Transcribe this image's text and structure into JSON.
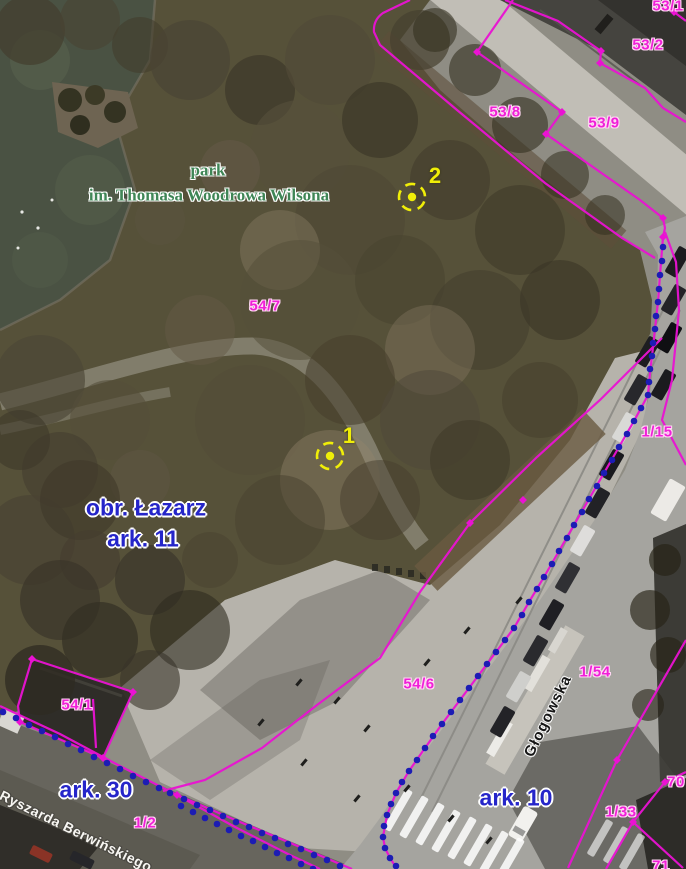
{
  "map": {
    "colors": {
      "boundary_line": "#ea12d3",
      "sheet_boundary_dot": "#1c1cb4",
      "marker_yellow": "#f0ee08",
      "parcel_label": "#f01fd8",
      "sheet_label": "#2525c9",
      "park_label": "#3f8656"
    },
    "labels": [
      {
        "name": "parcel-53-1",
        "text": "53/1",
        "x": 668,
        "y": 6,
        "cls": "parcel",
        "rot": 0
      },
      {
        "name": "parcel-53-2",
        "text": "53/2",
        "x": 648,
        "y": 45,
        "cls": "parcel",
        "rot": 0
      },
      {
        "name": "parcel-53-8",
        "text": "53/8",
        "x": 505,
        "y": 112,
        "cls": "parcel",
        "rot": 0
      },
      {
        "name": "parcel-53-9",
        "text": "53/9",
        "x": 604,
        "y": 123,
        "cls": "parcel",
        "rot": 0
      },
      {
        "name": "parcel-54-7",
        "text": "54/7",
        "x": 265,
        "y": 306,
        "cls": "parcel",
        "rot": 0
      },
      {
        "name": "parcel-1-15",
        "text": "1/15",
        "x": 657,
        "y": 432,
        "cls": "parcel",
        "rot": 0
      },
      {
        "name": "parcel-54-6",
        "text": "54/6",
        "x": 419,
        "y": 684,
        "cls": "parcel",
        "rot": 0
      },
      {
        "name": "parcel-1-54",
        "text": "1/54",
        "x": 595,
        "y": 672,
        "cls": "parcel",
        "rot": 0
      },
      {
        "name": "parcel-54-1",
        "text": "54/1",
        "x": 77,
        "y": 705,
        "cls": "parcel",
        "rot": 0
      },
      {
        "name": "parcel-1-2",
        "text": "1/2",
        "x": 145,
        "y": 823,
        "cls": "parcel",
        "rot": 0
      },
      {
        "name": "parcel-70",
        "text": "70",
        "x": 676,
        "y": 782,
        "cls": "parcel",
        "rot": 0
      },
      {
        "name": "parcel-1-33",
        "text": "1/33",
        "x": 621,
        "y": 812,
        "cls": "parcel",
        "rot": 0
      },
      {
        "name": "parcel-71",
        "text": "71",
        "x": 661,
        "y": 866,
        "cls": "parcel",
        "rot": 0
      },
      {
        "name": "park-name-line1",
        "text": "park",
        "x": 208,
        "y": 170,
        "cls": "park",
        "rot": 0
      },
      {
        "name": "park-name-line2",
        "text": "im. Thomasa Woodrowa Wilsona",
        "x": 209,
        "y": 195,
        "cls": "park",
        "rot": 0
      },
      {
        "name": "district-label",
        "text": "obr. Łazarz",
        "x": 146,
        "y": 508,
        "cls": "sheet",
        "rot": 0
      },
      {
        "name": "sheet-ark-11",
        "text": "ark. 11",
        "x": 143,
        "y": 539,
        "cls": "sheet",
        "rot": 0
      },
      {
        "name": "sheet-ark-30",
        "text": "ark. 30",
        "x": 96,
        "y": 790,
        "cls": "sheet",
        "rot": 0
      },
      {
        "name": "sheet-ark-10",
        "text": "ark. 10",
        "x": 516,
        "y": 798,
        "cls": "sheet",
        "rot": 0
      },
      {
        "name": "street-glogowska",
        "text": "Głogowska",
        "x": 548,
        "y": 716,
        "cls": "street-dark",
        "rot": -64
      },
      {
        "name": "street-berwinskiego",
        "text": "Ryszarda Berwińskiego",
        "x": 76,
        "y": 831,
        "cls": "street-light",
        "rot": 26
      },
      {
        "name": "marker-2-number",
        "text": "2",
        "x": 435,
        "y": 176,
        "cls": "marker",
        "rot": 0
      },
      {
        "name": "marker-1-number",
        "text": "1",
        "x": 349,
        "y": 436,
        "cls": "marker",
        "rot": 0
      }
    ],
    "markers": [
      {
        "id": "point-2",
        "cx": 412,
        "cy": 197
      },
      {
        "id": "point-1",
        "cx": 330,
        "cy": 456
      }
    ]
  }
}
